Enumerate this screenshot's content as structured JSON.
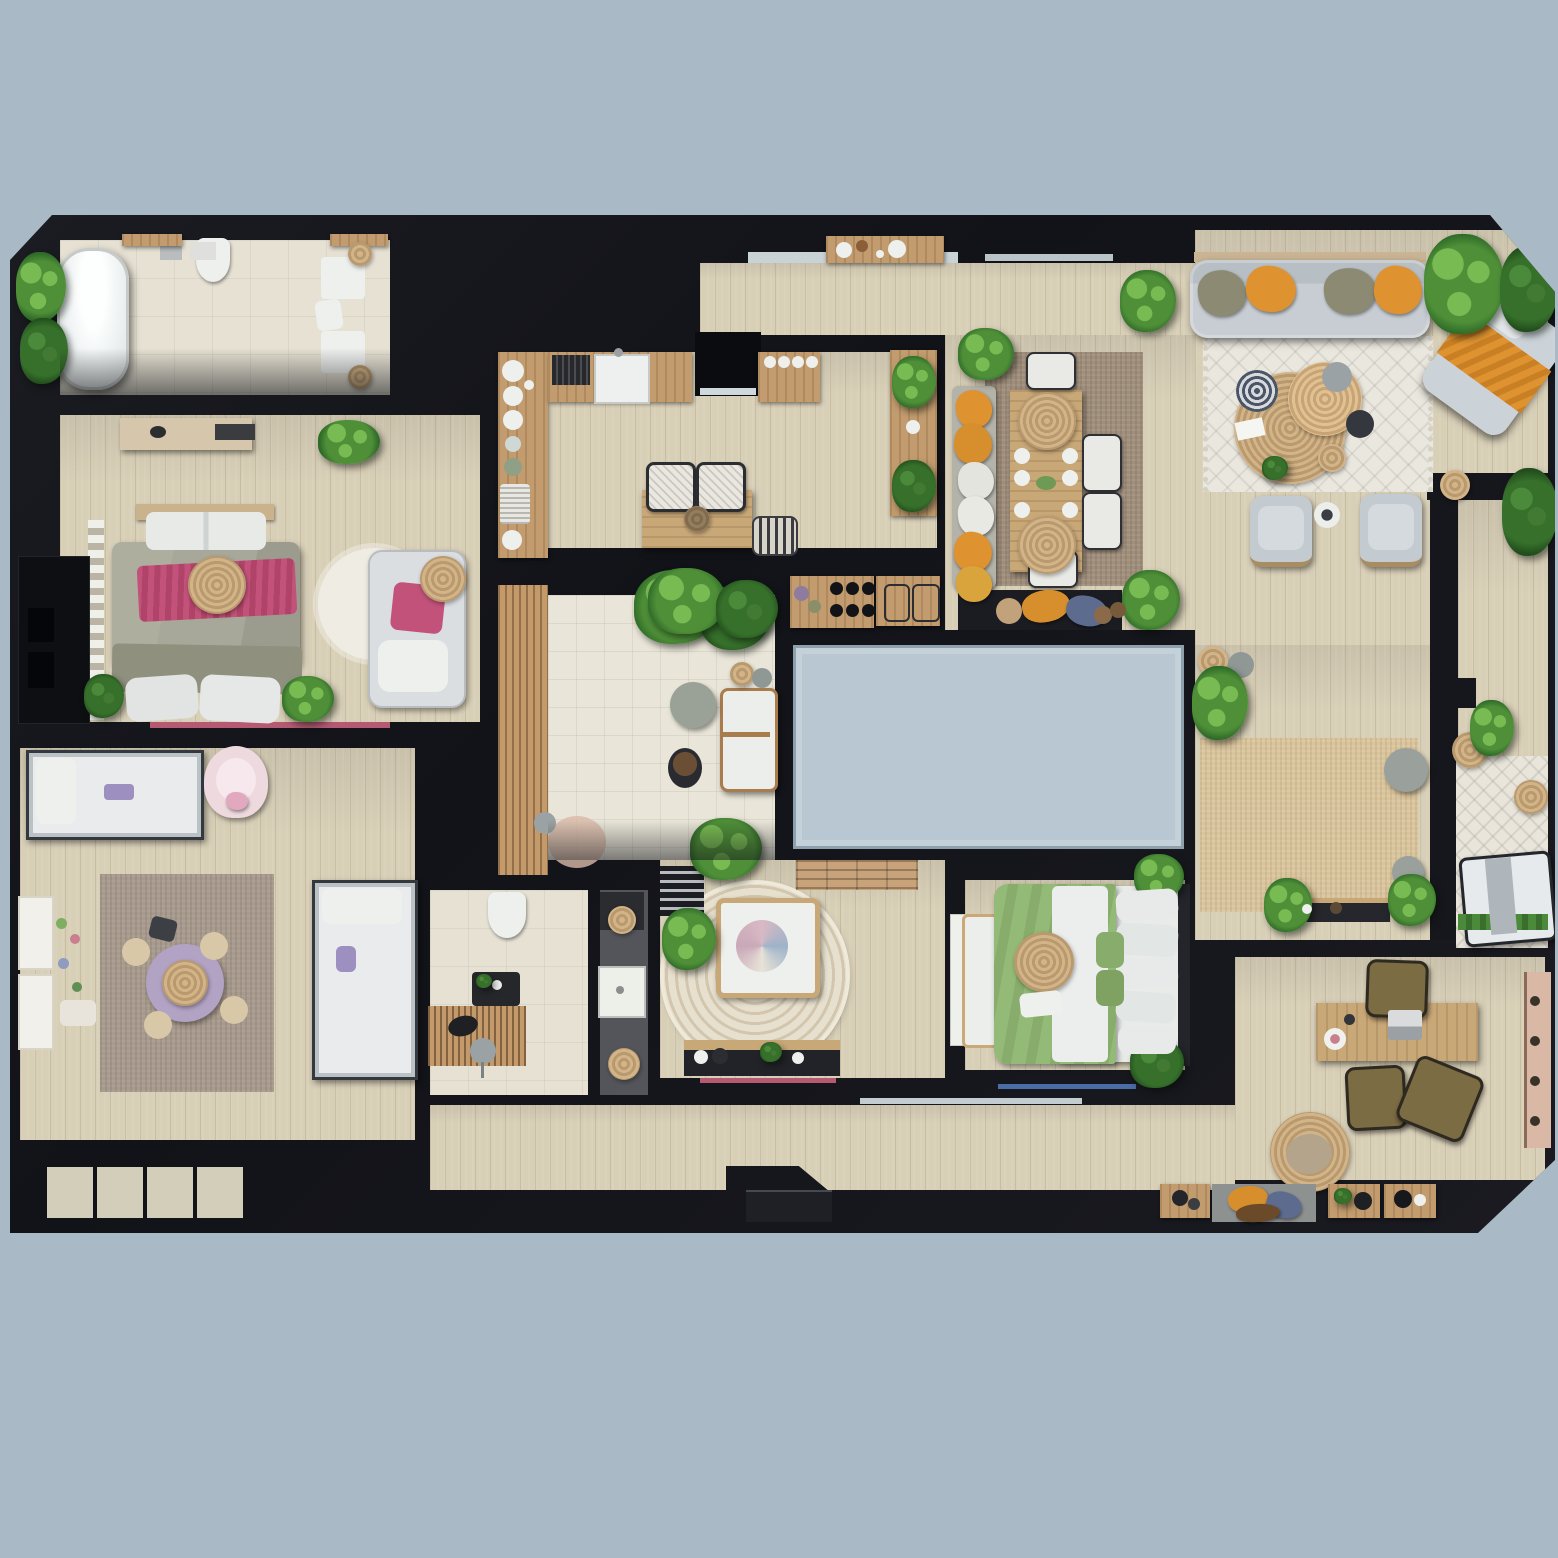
{
  "meta": {
    "type": "floor-plan-render",
    "view": "top-down",
    "description": "Top-down 3D rendered apartment floor plan with furnished rooms on a blue-gray background"
  },
  "palette": {
    "bg": "#a9bac6",
    "skylight": "#b8c7d1",
    "wall": "#16171c",
    "wood": "#d8cfb7",
    "tile": "#e9e5d8",
    "bath-tile": "#e6e1d3",
    "counter": "#c29c6e",
    "table": "#c9a878",
    "rug-living": "#eae7de",
    "rug-dining": "#a18f7c",
    "rug-jute": "#d9c49c",
    "rug-kids": "#a89a8d",
    "rug-terrace": "#e9e5da",
    "jute": "#c9ad80",
    "sofa": "#c7cdd2",
    "cushion-olive": "#8c8a72",
    "cushion-orange": "#df9230",
    "cushion-blue": "#5d6c8e",
    "pink": "#c2527a",
    "duvet-gray": "#a8a89a",
    "duvet-green": "#94ba77",
    "purple": "#b2a3c4",
    "plant": "#4f8f38",
    "plant-light": "#79bb53",
    "plant-dark": "#2f6b28",
    "olive-chair": "#7c6c44",
    "white-soft": "#eef0ee"
  },
  "rooms": [
    {
      "name": "ensuite-bathroom",
      "items": [
        "freestanding-bathtub",
        "plant",
        "toilet",
        "double-vanity",
        "bath-mats",
        "towel"
      ]
    },
    {
      "name": "master-bedroom",
      "items": [
        "double-bed",
        "pink-throw",
        "jute-pillow",
        "round-white-rug",
        "daybed",
        "dresser",
        "wardrobe-rail",
        "closet",
        "plants"
      ]
    },
    {
      "name": "kids-bedroom",
      "items": [
        "metal-bed",
        "second-metal-bed",
        "pink-armchair",
        "play-rug",
        "purple-play-mat",
        "poufs",
        "toy-shelves"
      ]
    },
    {
      "name": "kitchen",
      "items": [
        "left-counter-with-dishes",
        "sink-counter",
        "utensil-block",
        "jar-counter",
        "side-counter",
        "small-table",
        "two-chairs",
        "basket",
        "hob-counter",
        "trays",
        "plants"
      ]
    },
    {
      "name": "entry-hall",
      "items": [
        "door-threshold",
        "console-with-bowls",
        "window",
        "plant"
      ]
    },
    {
      "name": "dining-area",
      "items": [
        "bench-with-pillows",
        "dining-table",
        "jute-pendant-lamps",
        "plates",
        "white-chairs",
        "plants",
        "pillow-bench"
      ]
    },
    {
      "name": "living-room",
      "items": [
        "sofa",
        "olive-pillows",
        "orange-pillows",
        "patterned-rug",
        "jute-coffee-tables",
        "armchairs",
        "side-table",
        "chaise-with-orange-throw",
        "plants"
      ]
    },
    {
      "name": "patio-courtyard",
      "items": [
        "tile-floor",
        "wood-deck",
        "outdoor-sofa",
        "round-table",
        "planters",
        "plants"
      ]
    },
    {
      "name": "skylight",
      "items": [
        "glass-panel"
      ]
    },
    {
      "name": "family-hall",
      "items": [
        "jute-rug",
        "gray-poufs",
        "baskets",
        "console",
        "plants"
      ]
    },
    {
      "name": "nursery",
      "items": [
        "round-rug",
        "crib",
        "swirl-blanket",
        "console",
        "plant",
        "striped-mat",
        "door"
      ]
    },
    {
      "name": "green-bedroom",
      "items": [
        "double-bed-green-duvet",
        "pillows",
        "jute-decor",
        "foot-bench",
        "plants"
      ]
    },
    {
      "name": "family-bathroom",
      "items": [
        "toilet",
        "vanity",
        "wood-shower-deck",
        "stool",
        "shower-tray",
        "baskets"
      ]
    },
    {
      "name": "office",
      "items": [
        "desk",
        "laptop",
        "desk-chair",
        "guest-chairs",
        "jute-rug",
        "wall-shelf",
        "pouf",
        "consoles",
        "pillow-bench"
      ]
    },
    {
      "name": "terrace",
      "items": [
        "wood-deck",
        "patterned-rug",
        "daybed-bench",
        "jute-tables",
        "plants",
        "planting-strip"
      ]
    }
  ]
}
